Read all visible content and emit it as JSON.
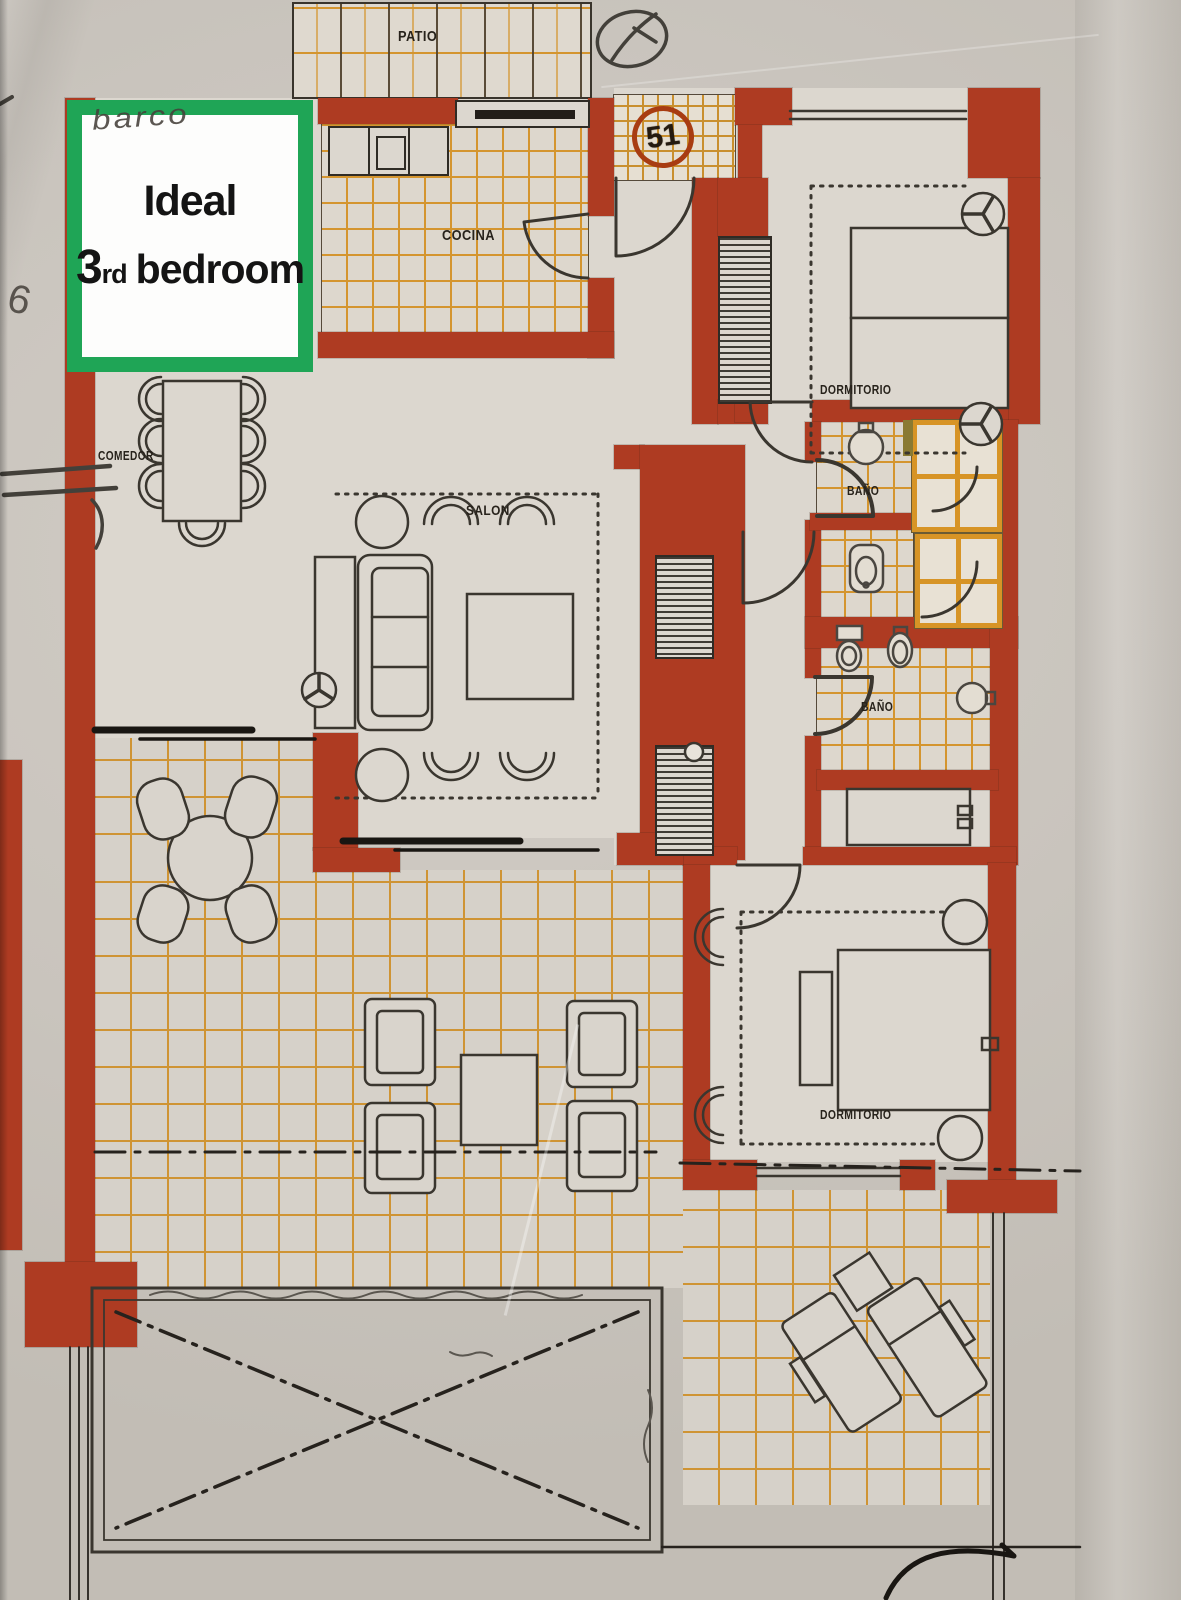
{
  "annotation": {
    "line1": "Ideal",
    "line2_big": "3",
    "line2_small": "rd",
    "line2_rest": "bedroom",
    "border_color": "#1fa556"
  },
  "unit": {
    "number": "51"
  },
  "rooms": {
    "patio": {
      "label": "PATIO"
    },
    "cocina": {
      "label": "COCINA"
    },
    "comedor": {
      "label": "COMEDOR"
    },
    "salon": {
      "label": "SALON"
    },
    "dormitorio_top": {
      "label": "DORMITORIO"
    },
    "bano_top": {
      "label": "BAÑO"
    },
    "bano_bottom": {
      "label": "BAÑO"
    },
    "dormitorio_bottom": {
      "label": "DORMITORIO"
    }
  },
  "handwriting": {
    "note": "barco",
    "digit": "6"
  },
  "colors": {
    "wall_red": "#ae3b22",
    "tile_orange": "#d4952f",
    "annotation_green": "#1fa556",
    "paper": "#c9c4bd",
    "floor": "#dcd7cf",
    "badge_ring": "#a83c12"
  }
}
